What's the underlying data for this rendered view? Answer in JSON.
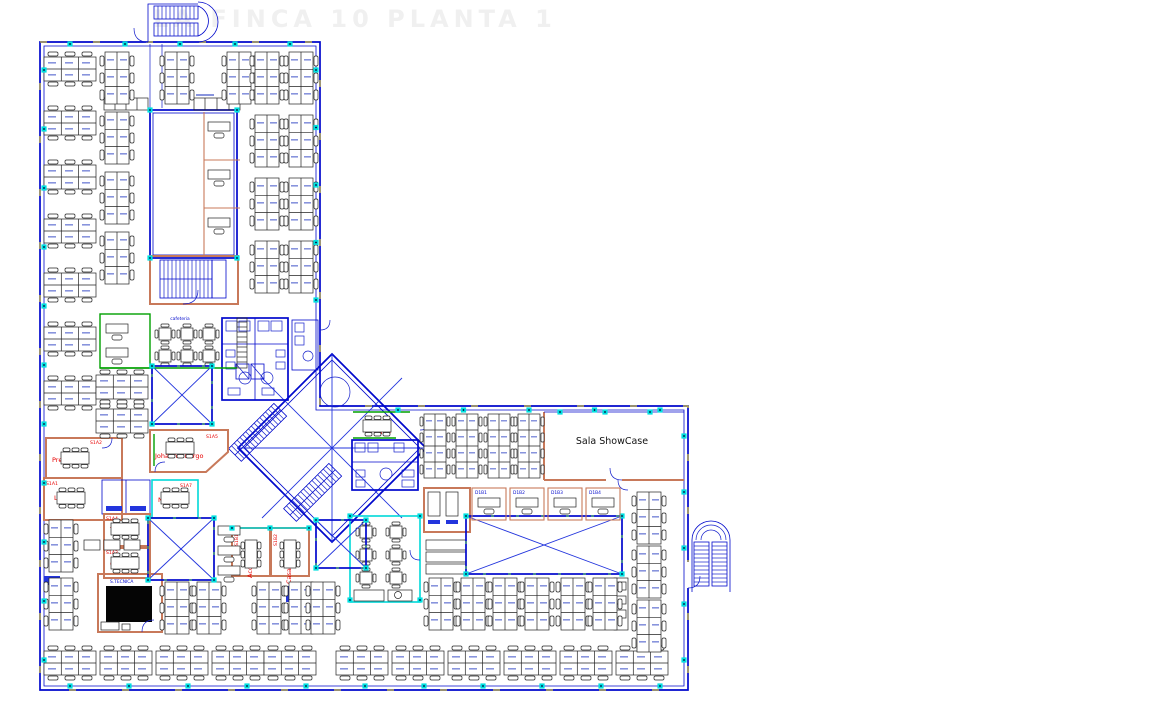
{
  "title": {
    "watermark": "LA FINCA 10 PLANTA 1"
  },
  "colors": {
    "wall_blue": "#0008cc",
    "partition_salmon": "#c8795a",
    "column_marker_cyan": "#00d8d8",
    "room_label_red": "#e80000",
    "accent_green": "#00a000",
    "survey_yellow": "#ffe600",
    "furniture_black": "#222222",
    "dark_room_fill": "#050505"
  },
  "rooms": {
    "showcase": {
      "name": "Sala ShowCase"
    },
    "pretoria": {
      "code": "S1A2",
      "name": "Pretoria"
    },
    "lagos": {
      "code": "S1A1",
      "name": "Lagos"
    },
    "johannesburgo": {
      "code": "S1A5",
      "name": "Johannesburgo"
    },
    "nairobi": {
      "code": "S1A7",
      "name": "Nairobi"
    },
    "telaviv": {
      "code": "S1A4",
      "name": "Tel Aviv"
    },
    "oporto": {
      "code": "S1A3",
      "name": "Oporto"
    },
    "elcairo": {
      "name": "El Cairo"
    },
    "accra": {
      "code": "S1B1",
      "name": "Accra"
    },
    "casablanca": {
      "code": "S1B2",
      "name": "Casablanca"
    },
    "cafeteria": {
      "name": "cafeteria"
    },
    "tecnica": {
      "name": "S.TECNICA"
    },
    "booths": [
      {
        "code": "D1B1"
      },
      {
        "code": "D1B2"
      },
      {
        "code": "D1B3"
      },
      {
        "code": "D1B4"
      }
    ]
  },
  "plan": {
    "desks_h": [
      [
        44,
        52
      ],
      [
        44,
        106
      ],
      [
        44,
        160
      ],
      [
        44,
        214
      ],
      [
        44,
        268
      ],
      [
        44,
        322
      ],
      [
        44,
        376
      ],
      [
        96,
        370
      ],
      [
        96,
        404
      ],
      [
        44,
        646
      ],
      [
        100,
        646
      ],
      [
        156,
        646
      ],
      [
        212,
        646
      ],
      [
        264,
        646
      ],
      [
        336,
        646
      ],
      [
        392,
        646
      ],
      [
        448,
        646
      ],
      [
        504,
        646
      ],
      [
        560,
        646
      ],
      [
        616,
        646
      ]
    ],
    "desks_v": [
      [
        100,
        52
      ],
      [
        100,
        112
      ],
      [
        100,
        172
      ],
      [
        100,
        232
      ],
      [
        160,
        52
      ],
      [
        222,
        52
      ],
      [
        250,
        52
      ],
      [
        284,
        52
      ],
      [
        250,
        115
      ],
      [
        284,
        115
      ],
      [
        250,
        178
      ],
      [
        284,
        178
      ],
      [
        250,
        241
      ],
      [
        284,
        241
      ],
      [
        44,
        520
      ],
      [
        44,
        578
      ],
      [
        160,
        582
      ],
      [
        192,
        582
      ],
      [
        252,
        582
      ],
      [
        284,
        582
      ],
      [
        306,
        582
      ],
      [
        632,
        492
      ],
      [
        632,
        546
      ],
      [
        632,
        600
      ],
      [
        424,
        578
      ],
      [
        456,
        578
      ],
      [
        488,
        578
      ],
      [
        520,
        578
      ],
      [
        556,
        578
      ],
      [
        588,
        578
      ]
    ],
    "bench8_v": [
      [
        420,
        414
      ],
      [
        452,
        414
      ],
      [
        484,
        414
      ],
      [
        514,
        414
      ]
    ],
    "single_desks": [
      [
        206,
        120
      ],
      [
        206,
        168
      ],
      [
        206,
        216
      ],
      [
        104,
        322
      ],
      [
        104,
        346
      ],
      [
        216,
        524
      ],
      [
        216,
        544
      ],
      [
        216,
        564
      ]
    ],
    "cafe_tables": [
      [
        155,
        324
      ],
      [
        177,
        324
      ],
      [
        199,
        324
      ],
      [
        155,
        346
      ],
      [
        177,
        346
      ],
      [
        199,
        346
      ],
      [
        356,
        522
      ],
      [
        386,
        522
      ],
      [
        356,
        545
      ],
      [
        386,
        545
      ],
      [
        356,
        568
      ],
      [
        386,
        568
      ]
    ],
    "meeting_tables": [
      [
        58,
        448,
        0
      ],
      [
        54,
        488,
        0
      ],
      [
        158,
        488,
        0
      ],
      [
        163,
        438,
        0
      ],
      [
        108,
        519,
        0
      ],
      [
        108,
        553,
        0
      ],
      [
        360,
        416,
        0
      ],
      [
        261,
        537,
        90
      ],
      [
        300,
        537,
        90
      ]
    ],
    "xvoids": [
      [
        152,
        366,
        60,
        58
      ],
      [
        148,
        518,
        66,
        62
      ],
      [
        316,
        520,
        50,
        48
      ],
      [
        466,
        516,
        156,
        58
      ]
    ],
    "marker_segments": [
      [
        70,
        44,
        290,
        44,
        5
      ],
      [
        44,
        70,
        44,
        660,
        11
      ],
      [
        70,
        686,
        660,
        686,
        11
      ],
      [
        684,
        436,
        684,
        660,
        5
      ],
      [
        398,
        410,
        660,
        410,
        5
      ],
      [
        316,
        70,
        316,
        300,
        5
      ],
      [
        560,
        412,
        650,
        412,
        3
      ]
    ],
    "marker_points": [
      [
        150,
        110
      ],
      [
        237,
        110
      ],
      [
        150,
        258
      ],
      [
        237,
        258
      ],
      [
        152,
        366
      ],
      [
        212,
        366
      ],
      [
        152,
        424
      ],
      [
        212,
        424
      ],
      [
        148,
        518
      ],
      [
        214,
        518
      ],
      [
        148,
        580
      ],
      [
        214,
        580
      ],
      [
        316,
        520
      ],
      [
        366,
        520
      ],
      [
        316,
        568
      ],
      [
        366,
        568
      ],
      [
        466,
        516
      ],
      [
        622,
        516
      ],
      [
        466,
        574
      ],
      [
        622,
        574
      ],
      [
        350,
        516
      ],
      [
        420,
        516
      ],
      [
        350,
        600
      ],
      [
        420,
        600
      ],
      [
        232,
        528
      ],
      [
        270,
        528
      ],
      [
        309,
        528
      ]
    ],
    "booth_cells": [
      472,
      510,
      548,
      586
    ]
  }
}
